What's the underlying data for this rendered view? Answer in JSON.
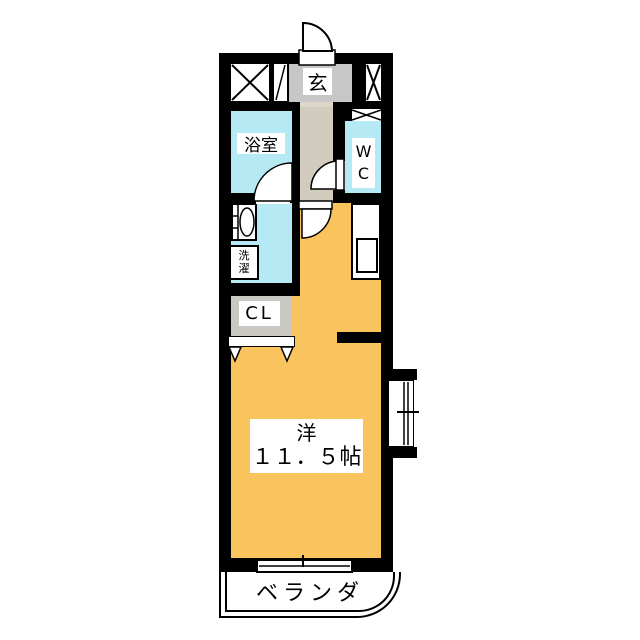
{
  "plan": {
    "type": "apartment-floor-plan",
    "labels": {
      "entrance": "玄",
      "bathroom": "浴室",
      "toilet": "WC",
      "laundry": "洗濯",
      "closet": "CL",
      "room_name": "洋",
      "room_size": "１１．５帖",
      "balcony": "ベランダ"
    },
    "colors": {
      "wall": "#000000",
      "main_room_floor": "#F9C45E",
      "wet_area_floor": "#B5EAF4",
      "entrance_floor": "#C7C7C7",
      "hallway_floor": "#D2CCBF",
      "closet_floor": "#CAC8C2",
      "background": "#FFFFFF"
    },
    "symbols": [
      "shaft-x-box",
      "pipe-shaft-slash",
      "vent-fan-bowtie",
      "entrance-door-swing",
      "bathroom-door-swing",
      "wc-door-swing",
      "room-door-swing",
      "closet-folding-door",
      "washbasin",
      "kitchen-counter-sink",
      "sliding-window-bay",
      "balcony-sliding-door"
    ]
  }
}
